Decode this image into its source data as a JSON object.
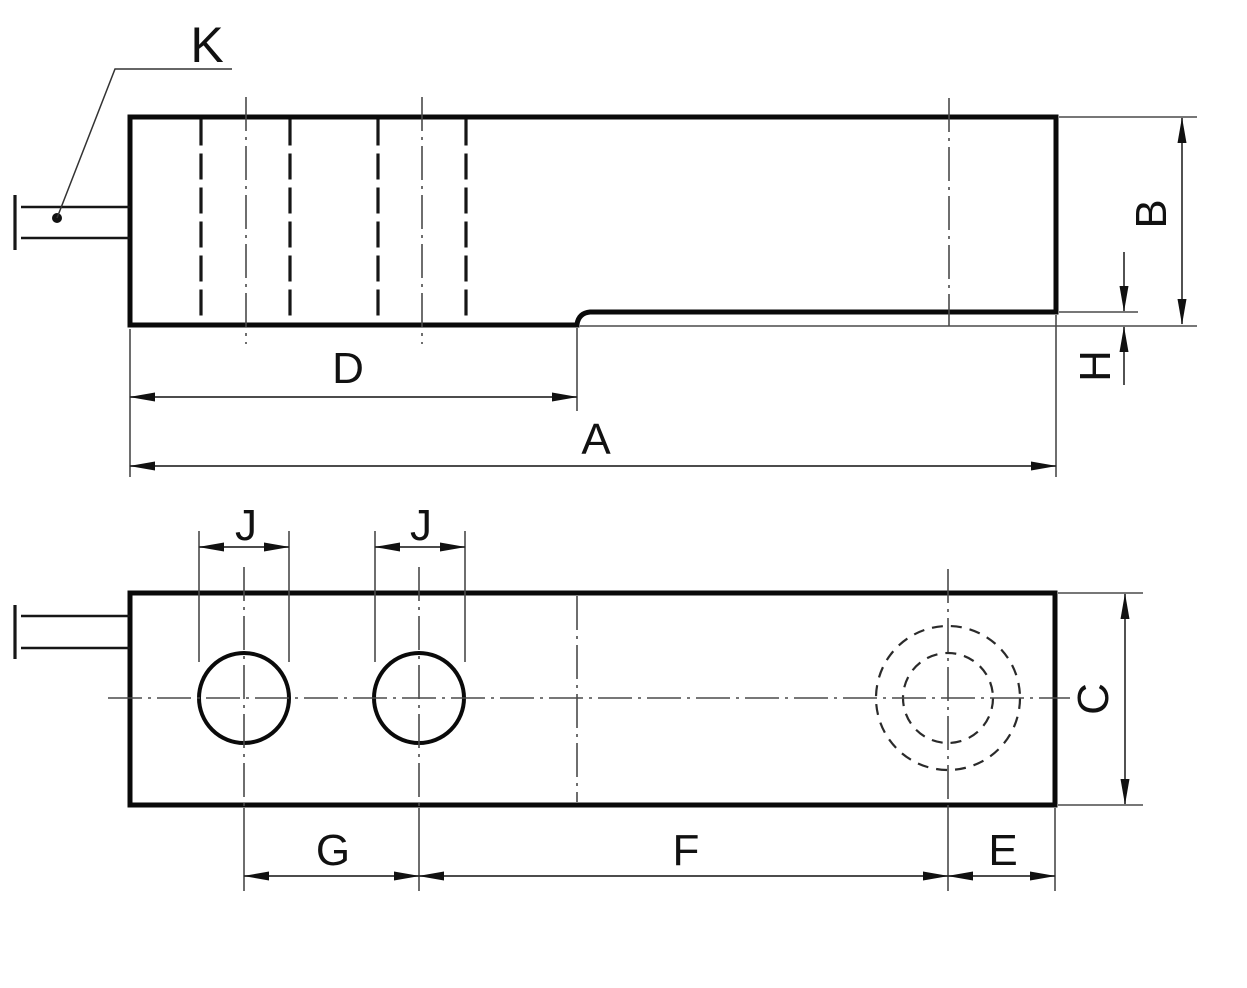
{
  "drawing": {
    "description": "Two-view dimension drawing of a shear-beam load cell body",
    "labels": {
      "cable": "K",
      "overall_length": "A",
      "overall_height": "B",
      "body_width": "C",
      "fixed_end_length": "D",
      "thread_hole_to_end": "E",
      "hole_to_thread_hole": "F",
      "mounting_hole_spacing": "G",
      "step_height": "H",
      "mounting_hole_diameter_1": "J",
      "mounting_hole_diameter_2": "J"
    },
    "colors": {
      "background": "#ffffff",
      "outline": "#0a0a0a",
      "thin_line": "#4a4a4a",
      "label": "#111111"
    }
  }
}
